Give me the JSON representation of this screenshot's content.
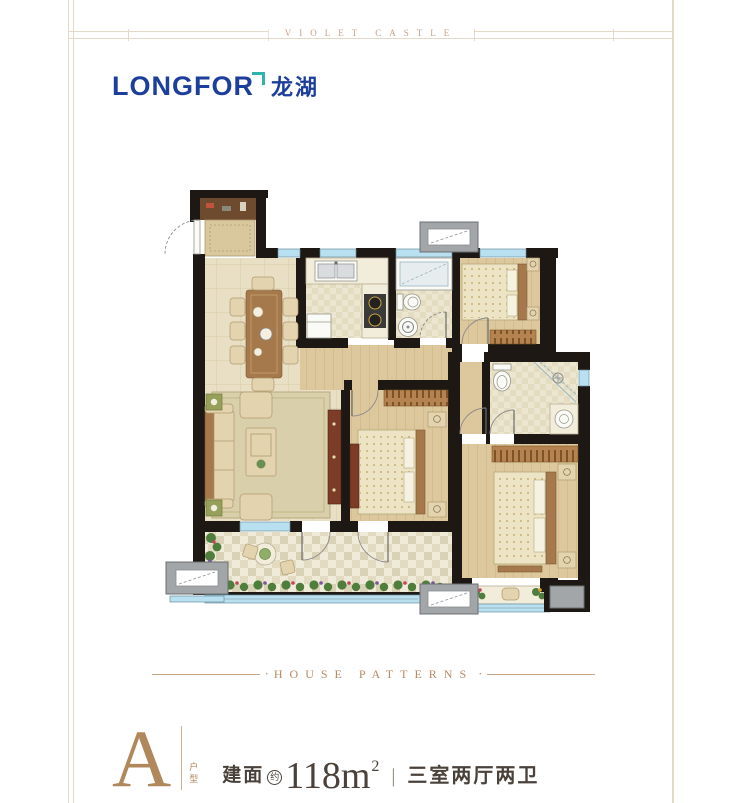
{
  "colors": {
    "pageBg": "#ffffff",
    "frameLine": "#e4d9cb",
    "ribbonText": "#c8a18b",
    "brandBlue": "#1d3f9c",
    "brandTeal": "#2fb3aa",
    "footerRibbon": "#b78a63",
    "unitLetter": "#b1875c",
    "unitText": "#4a423a",
    "wall": "#1d1814",
    "window": "#b9e0f0",
    "tileFloor": "#e9dfc5",
    "woodFloor": "#ddc89d",
    "bathFloor": "#ece6d0",
    "balconyFloor": "#f0ebd8",
    "counter": "#f2ecda",
    "fixture": "#fafaf6",
    "furnWood": "#a5794c",
    "furnLight": "#e3d3ae",
    "furnDark": "#6f4526",
    "tvCabinet": "#7c3c28",
    "duvet": "#ece4c4",
    "pillow": "#f6f2e2",
    "rug": "#d9cfab",
    "hatch": "#b5834f",
    "plant": "#4f7d3c",
    "flowerRed": "#c04858",
    "flowerPurple": "#7a55a0",
    "mat": "#d9c89e",
    "closet": "#6e4a2e",
    "acGray": "#a2a6a8",
    "arcLine": "#8a8a8a"
  },
  "header": {
    "ribbon_text": "VIOLET CASTLE"
  },
  "brand": {
    "name": "LONGFOR",
    "name_cn": "龙湖"
  },
  "footer": {
    "ribbon_text": "HOUSE PATTERNS",
    "dot": "·"
  },
  "unit": {
    "type_letter": "A",
    "type_label": "户型",
    "area_label": "建面",
    "area_note": "约",
    "area_value": "118m",
    "area_sup": "2",
    "separator": "|",
    "rooms_label": "三室两厅两卫"
  }
}
